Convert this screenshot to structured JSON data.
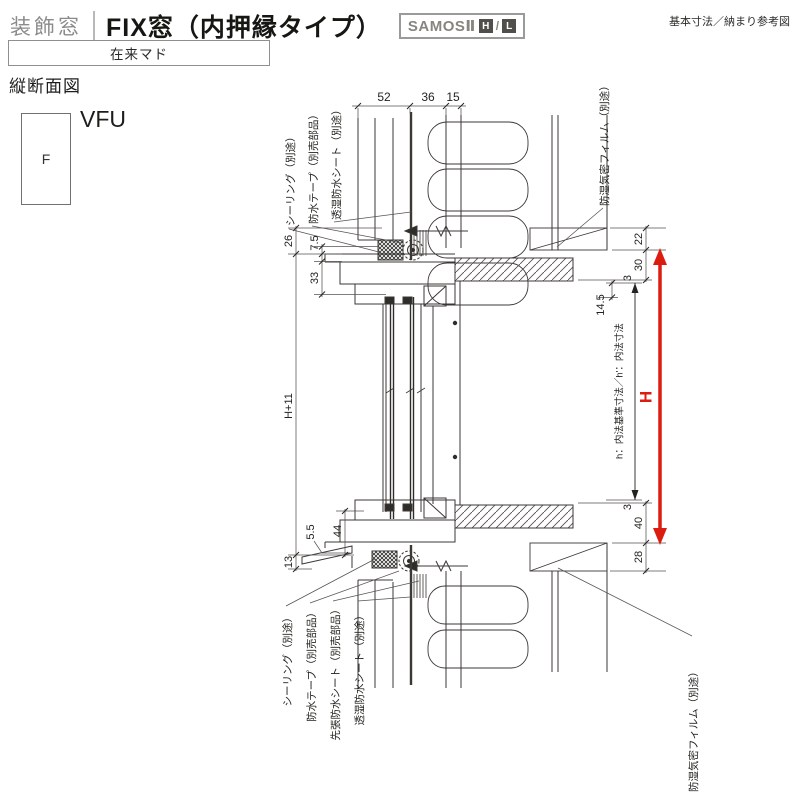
{
  "header": {
    "category": "装飾窓",
    "title": "FIX窓（内押縁タイプ）",
    "badge_series": "SAMOSⅡ",
    "badge_h": "H",
    "badge_sep": "/",
    "badge_l": "L",
    "ref_note": "基本寸法／納まり参考図",
    "frame_type": "在来マド"
  },
  "view": {
    "section_label": "縦断面図",
    "symbol": "F",
    "code": "VFU"
  },
  "dims": {
    "top": [
      "52",
      "36",
      "15"
    ],
    "d26": "26",
    "d75": "7.5",
    "d33": "33",
    "h_plus": "H+11",
    "d55": "5.5",
    "d44": "44",
    "d13": "13",
    "d22": "22",
    "d30": "30",
    "d3_top": "3",
    "d14_5": "14.5",
    "d3_bottom": "3",
    "d40": "40",
    "d28": "28",
    "H": "H",
    "h_note": "h：内法基準寸法／h'：内法寸法"
  },
  "materials": {
    "top": [
      "シーリング（別途）",
      "防水テープ（別売部品）",
      "透湿防水シート（別途）",
      "防湿気密フィルム（別途）"
    ],
    "bottom": [
      "シーリング（別途）",
      "防水テープ（別売部品）",
      "先張防水シート（別売部品）",
      "透湿防水シート（別途）",
      "防湿気密フィルム（別途）"
    ]
  },
  "colors": {
    "dimension_arrow_red": "#dd1c10",
    "line": "#3b3835"
  }
}
